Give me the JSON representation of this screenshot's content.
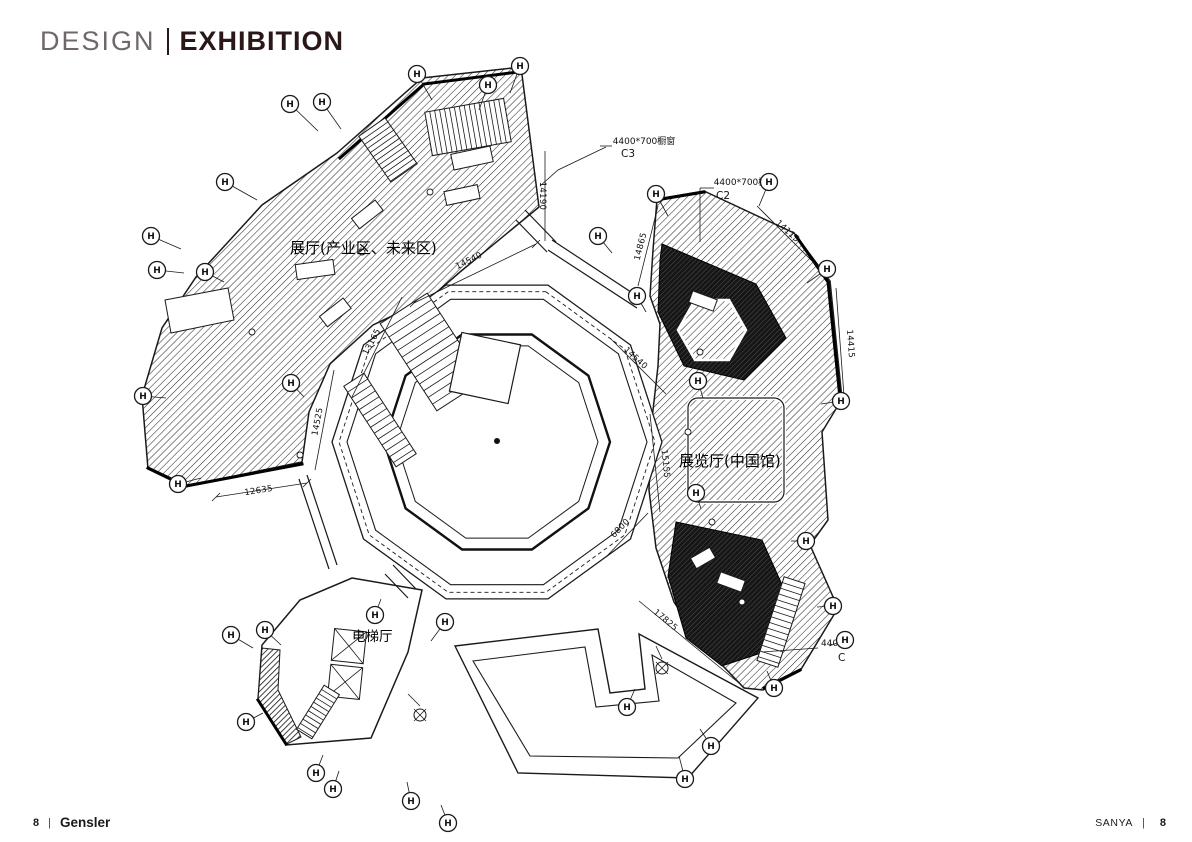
{
  "header": {
    "left": "DESIGN",
    "separator": "|",
    "right": "EXHIBITION"
  },
  "footer": {
    "left_page": "8",
    "left_sep": "|",
    "brand": "Gensler",
    "right_label": "SANYA",
    "right_sep": "|",
    "right_page": "8"
  },
  "colors": {
    "title_muted": "#6f6768",
    "title_strong": "#2a1818",
    "ink": "#1a1a1a"
  },
  "plan": {
    "rooms": [
      {
        "label": "展厅(产业区、未来区)"
      },
      {
        "label": "展览厅(中国馆)"
      },
      {
        "label": "电梯厅"
      }
    ],
    "annotations": [
      {
        "text": "4400*700橱窗",
        "code": "C3"
      },
      {
        "text": "4400*700橱窗",
        "code": "C2"
      },
      {
        "text": "4400*",
        "code": "C"
      }
    ],
    "dimensions": [
      {
        "value": "14540"
      },
      {
        "value": "14190"
      },
      {
        "value": "13165"
      },
      {
        "value": "14525"
      },
      {
        "value": "12635"
      },
      {
        "value": "14865"
      },
      {
        "value": "14115"
      },
      {
        "value": "14415"
      },
      {
        "value": "14540"
      },
      {
        "value": "15155"
      },
      {
        "value": "6800"
      },
      {
        "value": "17825"
      }
    ],
    "grid_bubble_label": "H"
  }
}
